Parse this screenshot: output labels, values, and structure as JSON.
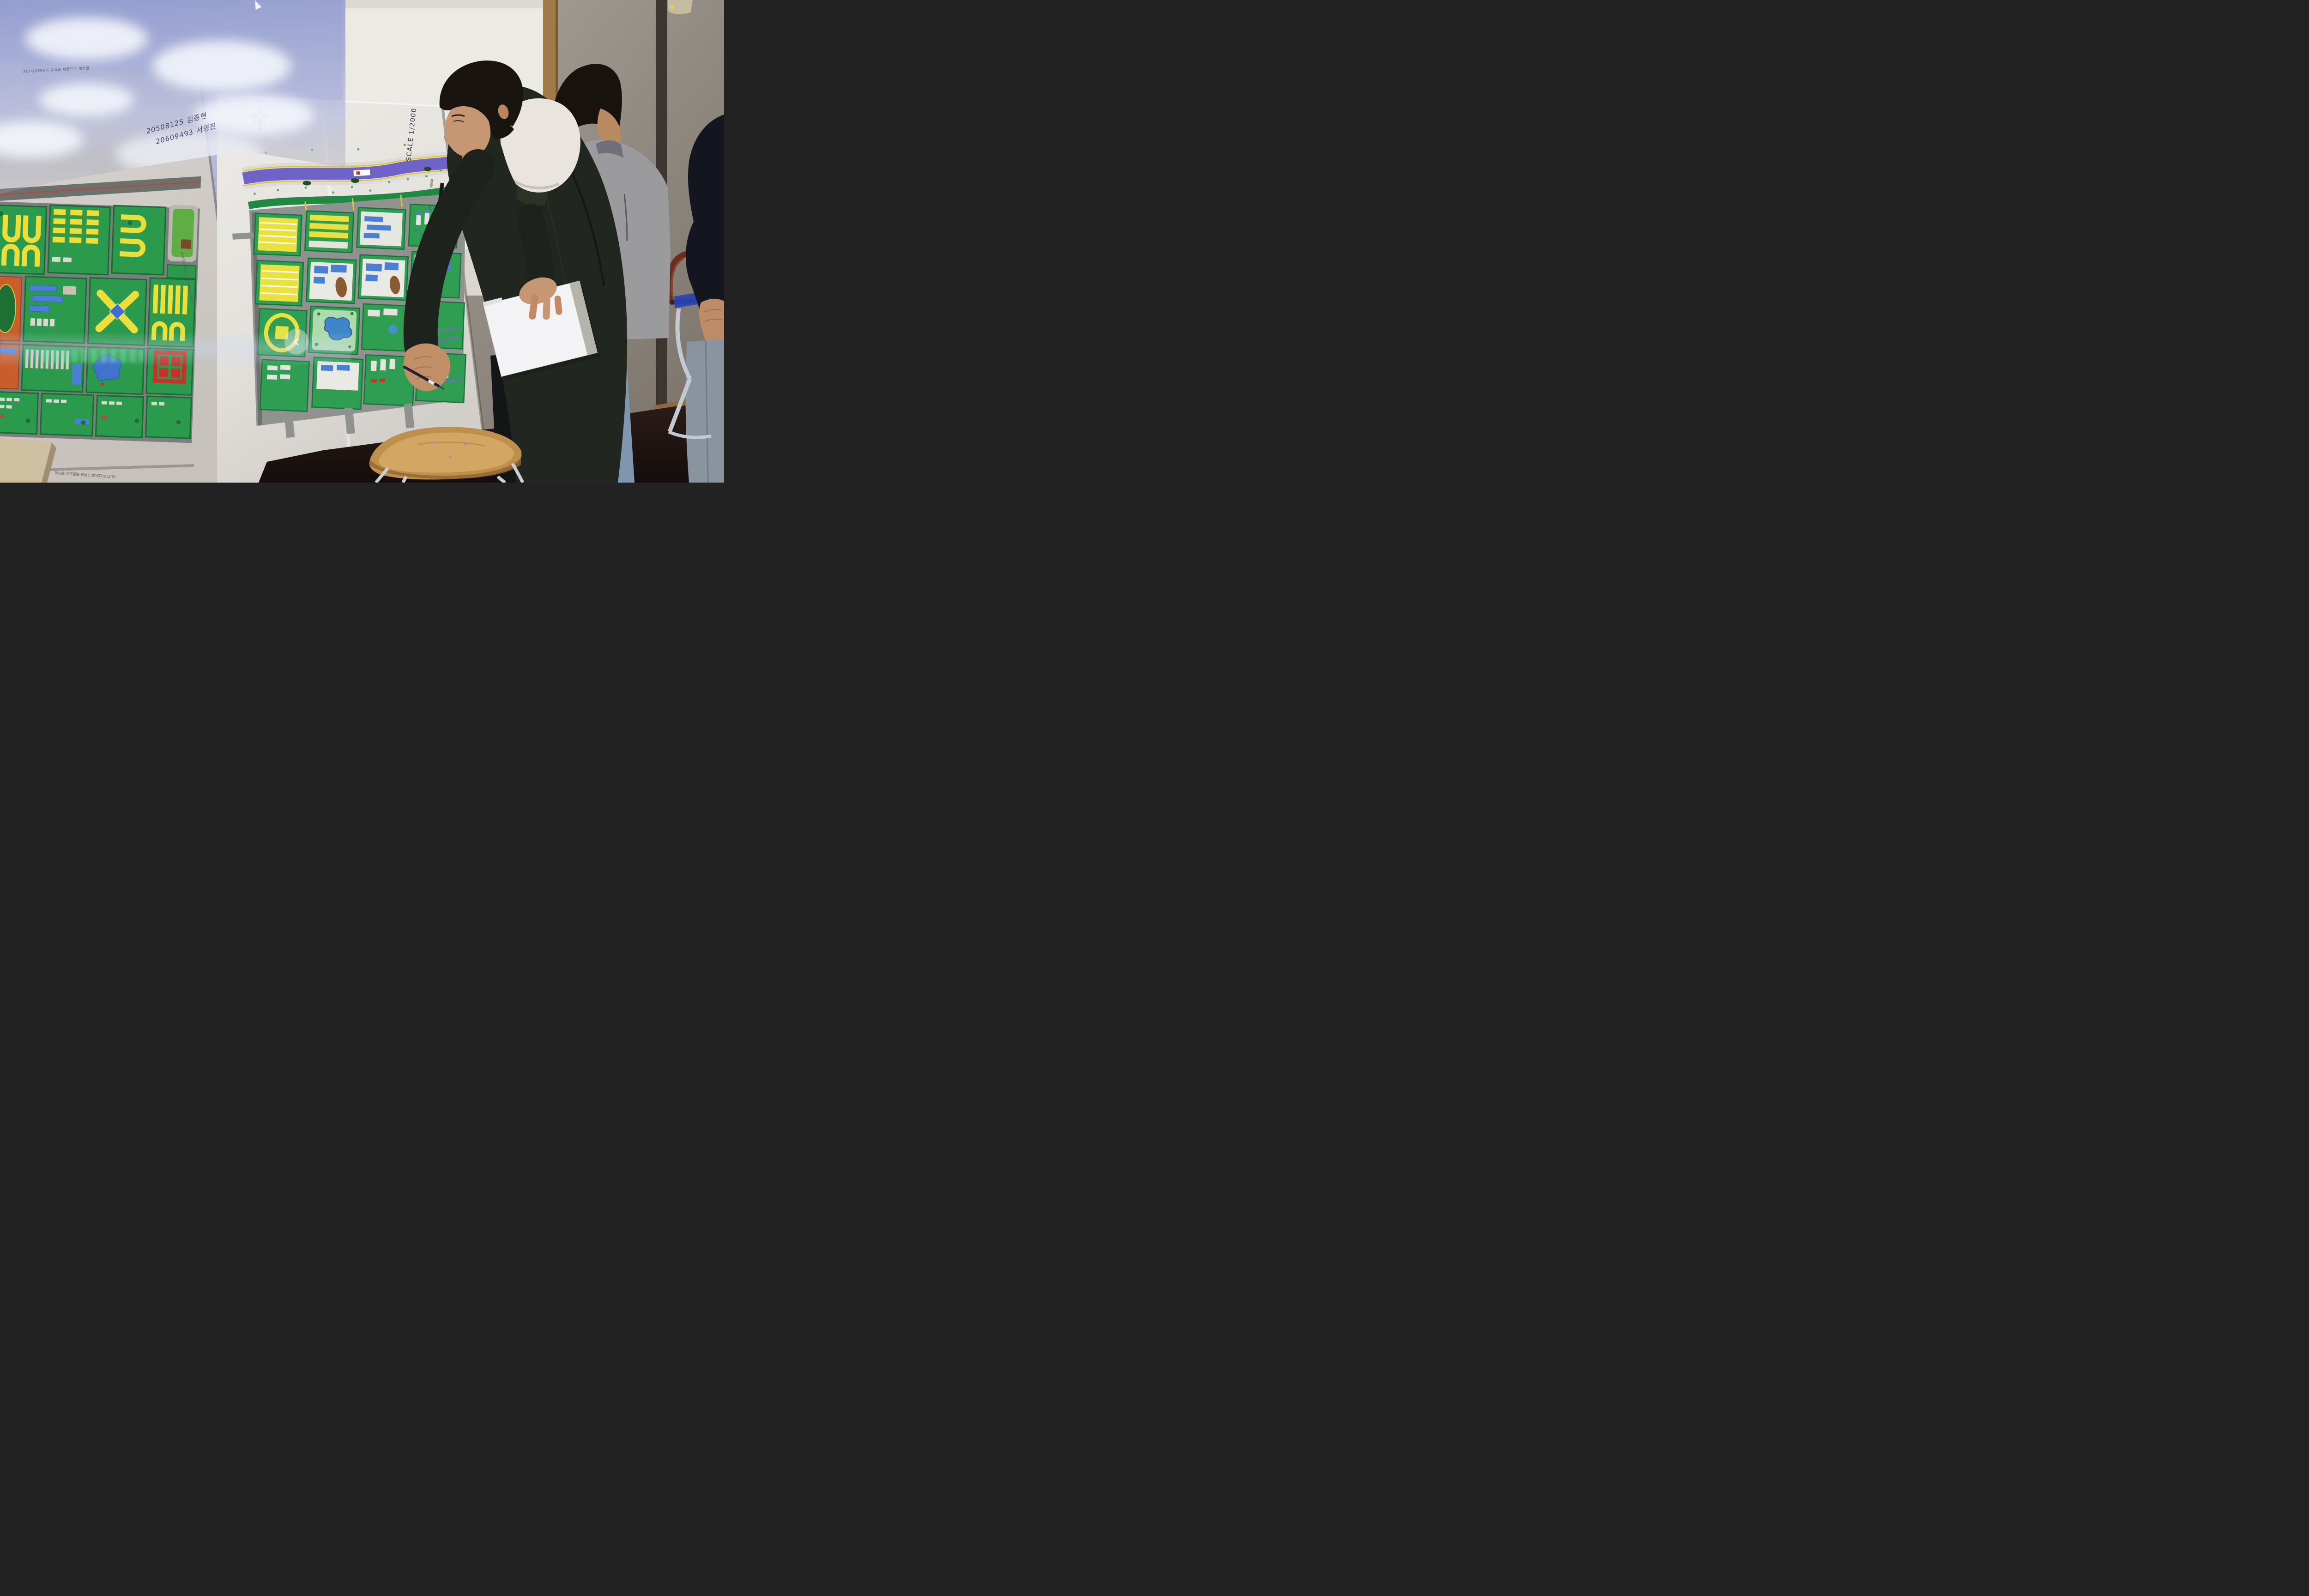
{
  "left_poster": {
    "handwriting": {
      "line1": "20508125 김종현",
      "line2": "20609493 서영진"
    },
    "watermark_top": "AUTODESK의 교육용 제품으로 제작됨",
    "watermark_side": "AUTODESK의 교육용 제품으로 제작됨",
    "watermark_bottom": "AUTODESK의 교육용 제품으로 제작됨"
  },
  "right_poster": {
    "scale_label": "SCALE 1/2000",
    "compass_north_label": "N",
    "scale_bar_ticks": [
      "0",
      "100",
      "250",
      "500M"
    ],
    "credits_vertical": "고용대 이규록 허두일 최다비"
  },
  "overlay": {
    "prev_arrow_glyph": "‹"
  },
  "palette": {
    "sky_projection": "#aeb4d8",
    "river_purple": "#6f63c8",
    "map_green": "#2f9e52",
    "housing_yellow": "#e9e23e",
    "sports_orange": "#c95e2a",
    "building_blue": "#4a7fd4",
    "alert_red": "#cc3326",
    "whiteboard_frame_wood": "#9f7b49",
    "stool_wood": "#c89a55"
  }
}
